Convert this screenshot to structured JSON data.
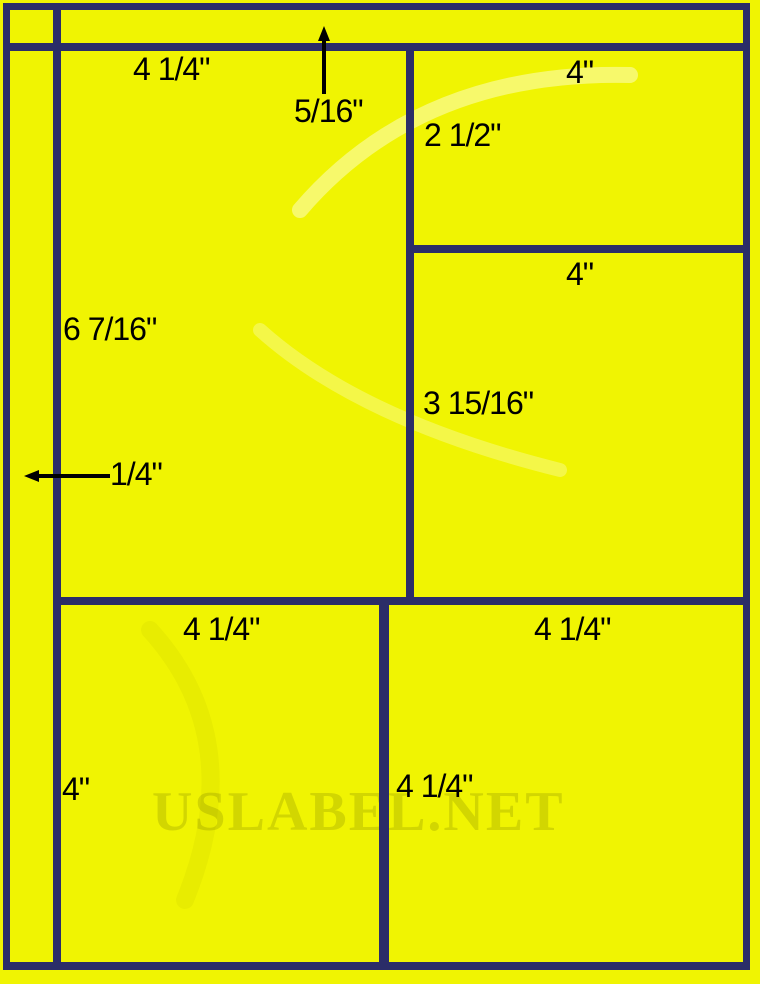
{
  "diagram": {
    "watermark_text": "USLABEL.NET",
    "colors": {
      "background": "#f0f402",
      "line": "#2b2d68",
      "text": "#000000"
    },
    "dimensions": {
      "main_label_width": "4 1/4\"",
      "main_label_height": "6 7/16\"",
      "top_margin": "5/16\"",
      "left_margin": "1/4\"",
      "top_right_label_width": "4\"",
      "top_right_label_height": "2 1/2\"",
      "mid_right_label_width": "4\"",
      "mid_right_label_height": "3 15/16\"",
      "bottom_left_label_width": "4 1/4\"",
      "bottom_left_label_height": "4\"",
      "bottom_right_label_width": "4 1/4\"",
      "bottom_right_label_height": "4 1/4\""
    }
  }
}
